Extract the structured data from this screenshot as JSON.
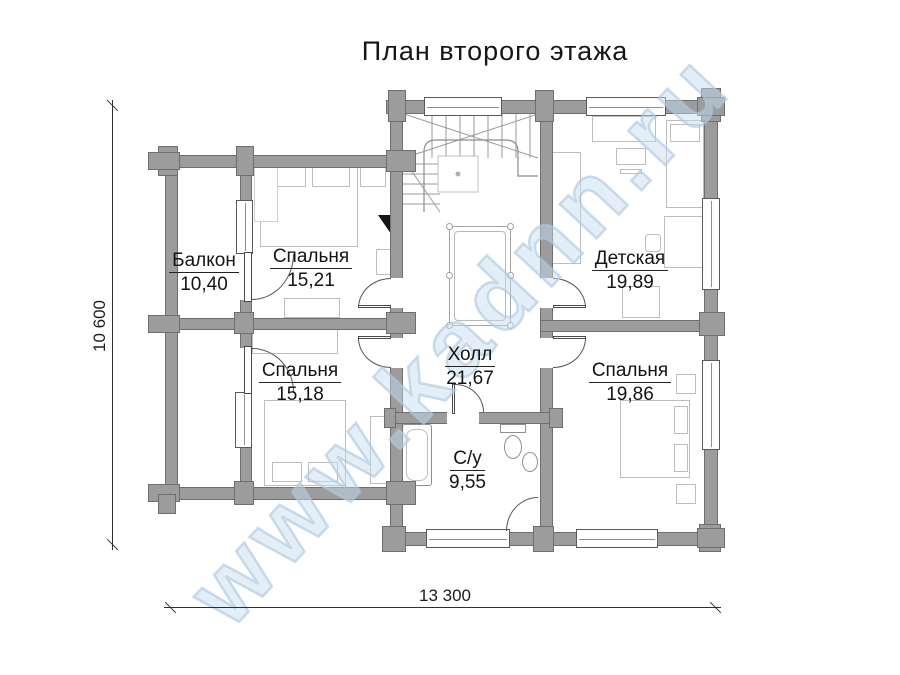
{
  "title": "План второго этажа",
  "watermark_text": "www.kadnn.ru",
  "rooms": {
    "balkon": {
      "name": "Балкон",
      "area": "10,40"
    },
    "bedroom1": {
      "name": "Спальня",
      "area": "15,21"
    },
    "detskaya": {
      "name": "Детская",
      "area": "19,89"
    },
    "bedroom2": {
      "name": "Спальня",
      "area": "15,18"
    },
    "hall": {
      "name": "Холл",
      "area": "21,67"
    },
    "bedroom3": {
      "name": "Спальня",
      "area": "19,86"
    },
    "su": {
      "name": "С/у",
      "area": "9,55"
    }
  },
  "dimensions": {
    "overall_width": "13 300",
    "overall_height": "10 600"
  },
  "colors": {
    "wall": "#9c9c9c",
    "wall_outline": "#6e6e6e",
    "furniture_line": "#bdbdbd",
    "watermark_blue": "#bcd2e4",
    "text": "#161616"
  }
}
